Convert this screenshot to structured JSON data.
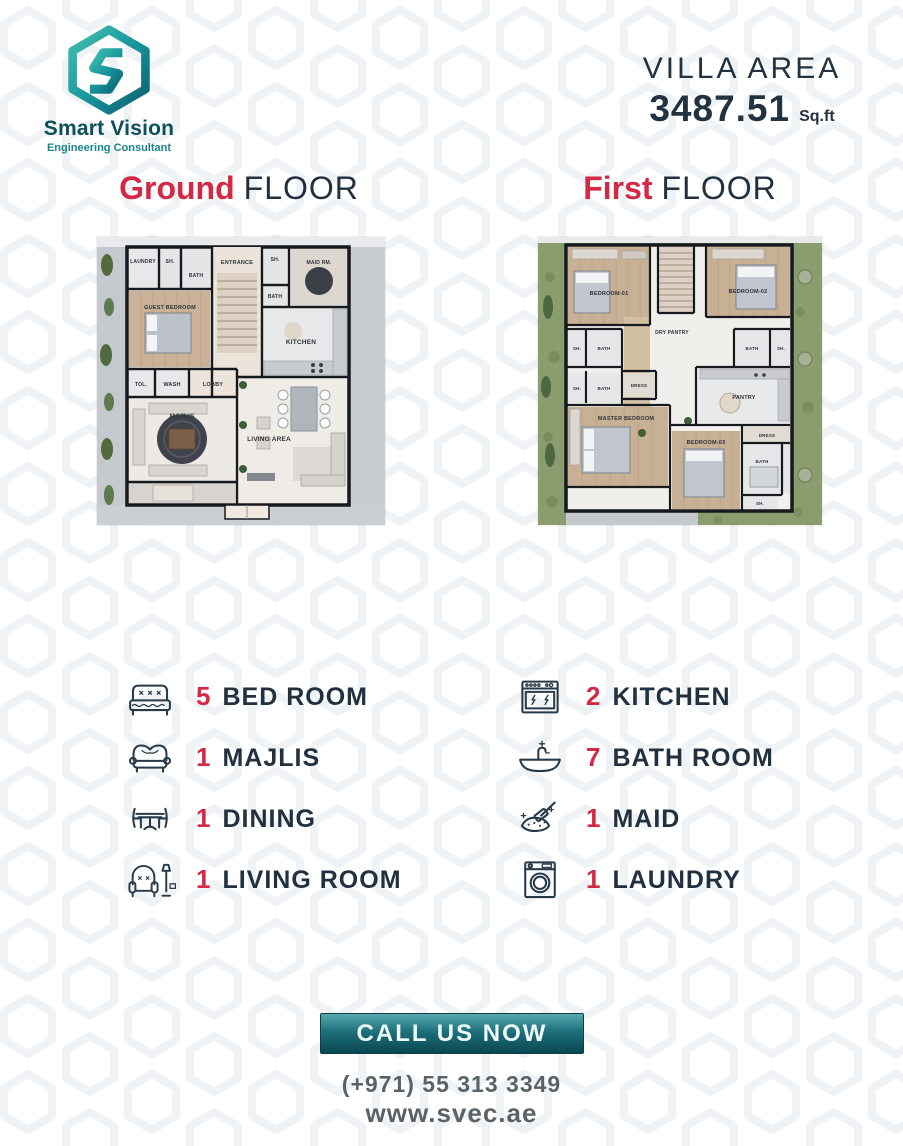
{
  "brand": {
    "name": "Smart Vision",
    "tagline": "Engineering Consultant"
  },
  "villa": {
    "label": "VILLA AREA",
    "value": "3487.51",
    "unit": "Sq.ft"
  },
  "headings": {
    "ground": {
      "accent": "Ground",
      "rest": "FLOOR"
    },
    "first": {
      "accent": "First",
      "rest": "FLOOR"
    }
  },
  "plans": {
    "ground": {
      "rooms": [
        "LAUNDRY",
        "SH.",
        "BATH",
        "ENTRANCE",
        "SH.",
        "BATH",
        "MAID RM.",
        "KITCHEN",
        "GUEST BEDROOM",
        "TOL.",
        "WASH",
        "LOBBY",
        "MAJLIS",
        "LIVING AREA"
      ]
    },
    "first": {
      "rooms": [
        "BEDROOM-01",
        "BEDROOM-02",
        "DRY PANTRY",
        "SH.",
        "BATH",
        "SH.",
        "BATH",
        "DRESS",
        "BATH",
        "SH.",
        "MASTER BEDROOM",
        "PANTRY",
        "BEDROOM-03",
        "DRESS",
        "BATH",
        "SH."
      ]
    }
  },
  "legend": {
    "left": [
      {
        "icon": "bed-icon",
        "count": "5",
        "label": "BED ROOM"
      },
      {
        "icon": "sofa-icon",
        "count": "1",
        "label": "MAJLIS"
      },
      {
        "icon": "dining-icon",
        "count": "1",
        "label": "DINING"
      },
      {
        "icon": "armchair-icon",
        "count": "1",
        "label": "LIVING ROOM"
      }
    ],
    "right": [
      {
        "icon": "stove-icon",
        "count": "2",
        "label": "KITCHEN"
      },
      {
        "icon": "bathtub-icon",
        "count": "7",
        "label": "BATH ROOM"
      },
      {
        "icon": "cleaning-icon",
        "count": "1",
        "label": "MAID"
      },
      {
        "icon": "washing-machine-icon",
        "count": "1",
        "label": "LAUNDRY"
      }
    ]
  },
  "cta": {
    "button": "CALL US NOW",
    "phone": "(+971) 55 313 3349",
    "website": "www.svec.ae"
  },
  "colors": {
    "accent_red": "#d32944",
    "dark": "#22313f",
    "teal": "#16929b",
    "teal_dark": "#0b5f6e"
  }
}
